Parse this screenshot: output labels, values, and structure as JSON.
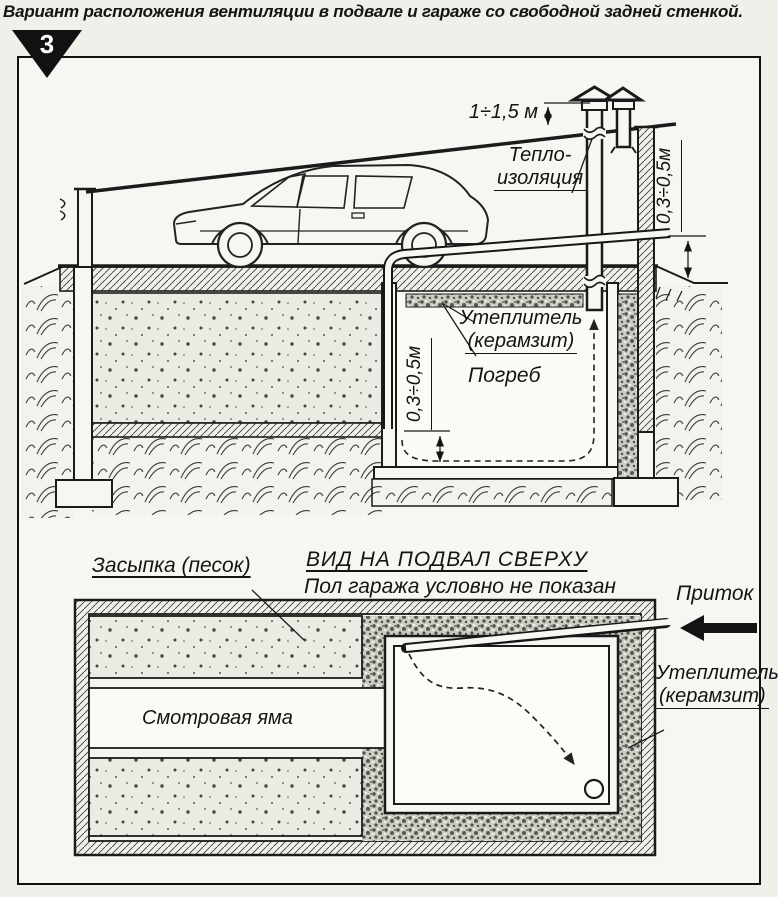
{
  "page": {
    "badge": "3",
    "title": "Вариант расположения вентиляции в подвале и гараже со свободной задней стенкой."
  },
  "section": {
    "stack_height": "1÷1,5 м",
    "thermal_insulation_line1": "Тепло-",
    "thermal_insulation_line2": "изоляция",
    "duct_ground_clearance": "0,3÷0,5м",
    "ceiling_insulation_line1": "Утеплитель",
    "ceiling_insulation_line2": "(керамзит)",
    "cellar": "Погреб",
    "pipe_floor_clearance": "0,3÷0,5м"
  },
  "plan": {
    "heading": "ВИД НА ПОДВАЛ СВЕРХУ",
    "subheading": "Пол гаража условно не показан",
    "backfill": "Засыпка (песок)",
    "inspection_pit": "Смотровая яма",
    "inflow": "Приток",
    "insulation_line1": "Утеплитель",
    "insulation_line2": "(керамзит)"
  },
  "colors": {
    "ink": "#1b1b1b",
    "paper": "#eef0ea"
  }
}
